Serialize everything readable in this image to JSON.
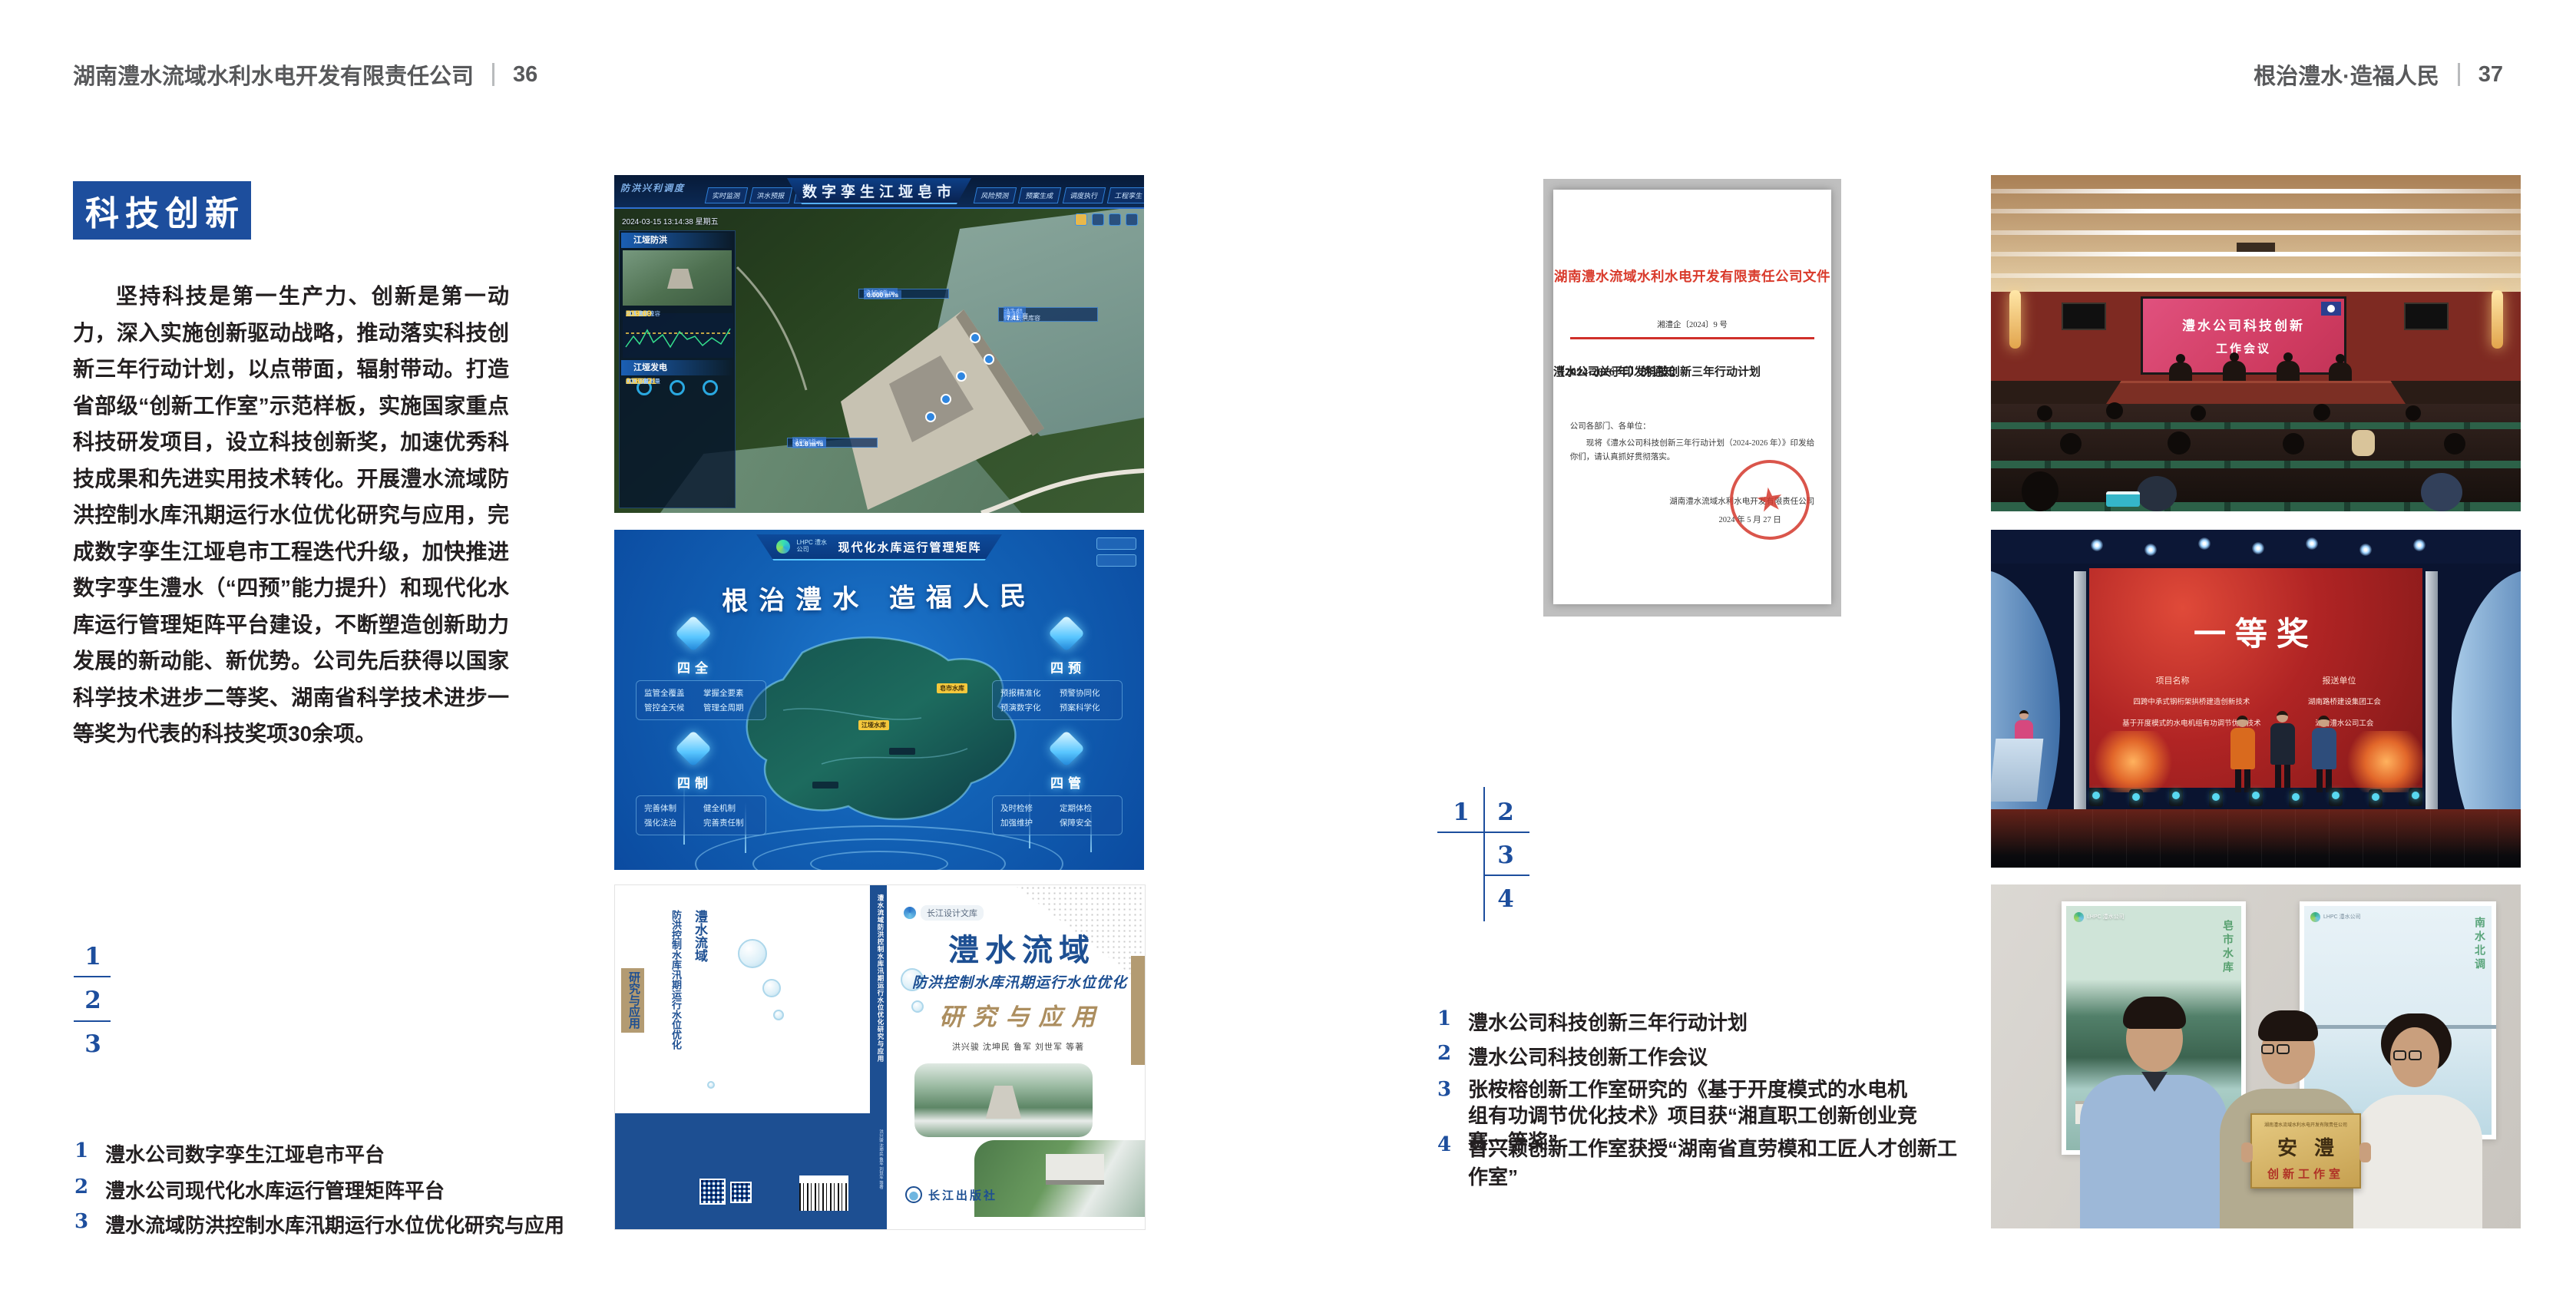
{
  "left_page": {
    "header": {
      "company": "湖南澧水流域水利水电开发有限责任公司",
      "page_no": "36"
    },
    "section_title": "科技创新",
    "paragraph": "坚持科技是第一生产力、创新是第一动力，深入实施创新驱动战略，推动落实科技创新三年行动计划，以点带面，辐射带动。打造省部级“创新工作室”示范样板，实施国家重点科技研发项目，设立科技创新奖，加速优秀科技成果和先进实用技术转化。开展澧水流域防洪控制水库汛期运行水位优化研究与应用，完成数字孪生江垭皂市工程迭代升级，加快推进数字孪生澧水（“四预”能力提升）和现代化水库运行管理矩阵平台建设，不断塑造创新助力发展的新动能、新优势。公司先后获得以国家科学技术进步二等奖、湖南省科学技术进步一等奖为代表的科技奖项30余项。",
    "figure_index": [
      "1",
      "2",
      "3"
    ],
    "captions": [
      {
        "num": "1",
        "text": "澧水公司数字孪生江垭皂市平台"
      },
      {
        "num": "2",
        "text": "澧水公司现代化水库运行管理矩阵平台"
      },
      {
        "num": "3",
        "text": "澧水流域防洪控制水库汛期运行水位优化研究与应用"
      }
    ]
  },
  "right_page": {
    "header": {
      "slogan": "根治澧水·造福人民",
      "page_no": "37"
    },
    "figure_index": [
      "1",
      "2",
      "3",
      "4"
    ],
    "captions": [
      {
        "num": "1",
        "text": "澧水公司科技创新三年行动计划"
      },
      {
        "num": "2",
        "text": "澧水公司科技创新工作会议"
      },
      {
        "num": "3",
        "text": "张桉榕创新工作室研究的《基于开度模式的水电机组有功调节优化技术》项目获“湘直职工创新创业竞赛一等奖”"
      },
      {
        "num": "4",
        "text": "曾兴颖创新工作室获授“湖南省直劳模和工匠人才创新工作室”"
      }
    ]
  },
  "document": {
    "red_head": "湖南澧水流域水利水电开发有限责任公司文件",
    "doc_no": "湘澧企〔2024〕9 号",
    "title_line1": "澧水公司关于印发科技创新三年行动计划",
    "title_line2": "（2024-2026 年）的通知",
    "salutation": "公司各部门、各单位：",
    "body": "现将《澧水公司科技创新三年行动计划（2024-2026 年）》印发给你们，请认真抓好贯彻落实。",
    "signer": "湖南澧水流域水利水电开发有限责任公司",
    "date": "2024 年 5 月 27 日",
    "seal_star": "★"
  },
  "dashboard": {
    "title": "数字孪生江垭皂市",
    "corner_label": "防洪兴利调度",
    "datetime": "2024-03-15 13:14:38 星期五",
    "tabs_left": [
      "实时监测",
      "洪水预报",
      "防洪预警"
    ],
    "tabs_right": [
      "风险预测",
      "预案生成",
      "调度执行",
      "工程孪生"
    ],
    "panel_flood": {
      "title": "江垭防洪",
      "stats": [
        {
          "label": "总库容",
          "value": "17.41"
        },
        {
          "label": "剩余防洪库容",
          "value": "7.41"
        },
        {
          "label": "坝上水位",
          "value": "215.69"
        },
        {
          "label": "蓄水量",
          "value": "8.10"
        },
        {
          "label": "入库流量",
          "value": "0.000"
        },
        {
          "label": "出库流量",
          "value": "61.8"
        },
        {
          "label": "正常蓄水位",
          "value": "236.00"
        },
        {
          "label": "汛限水位",
          "value": "219.60"
        }
      ]
    },
    "panel_power": {
      "title": "江垭发电",
      "stats": [
        {
          "label": "年发电台数",
          "value": "6.3000"
        },
        {
          "label": "年累计发电量",
          "value": "1.2907"
        },
        {
          "label": "月累计发电量",
          "value": "3359.21"
        },
        {
          "label": "当前出力",
          "value": "0.00"
        },
        {
          "label": "发电流量",
          "value": "0.00"
        },
        {
          "label": "弃水流量",
          "value": "0.00"
        }
      ]
    },
    "callout_up": [
      {
        "label": "坝上水位",
        "value": "215.69 m"
      },
      {
        "label": "入库流量",
        "value": "0.000 m³/s"
      }
    ],
    "callout_cap": [
      {
        "label": "总库容",
        "value": "17.41"
      },
      {
        "label": "蓄水量",
        "value": "8.10"
      },
      {
        "label": "防洪库容",
        "value": "7.41"
      },
      {
        "label": "剩余防洪库容",
        "value": "7.41"
      }
    ],
    "callout_down": [
      {
        "label": "坝下水位",
        "value": "106.19 m"
      },
      {
        "label": "出库流量",
        "value": "61.8 m³/s"
      }
    ]
  },
  "matrix": {
    "brand": "LHPC 澧水公司",
    "title": "现代化水库运行管理矩阵",
    "slogan": "根治澧水 造福人民",
    "marker1": "皂市水库",
    "marker2": "江垭水库",
    "groups": [
      {
        "name": "四全",
        "items": [
          "监管全覆盖",
          "掌握全要素",
          "管控全天候",
          "管理全周期"
        ]
      },
      {
        "name": "四预",
        "items": [
          "预报精准化",
          "预警协同化",
          "预演数字化",
          "预案科学化"
        ]
      },
      {
        "name": "四制",
        "items": [
          "完善体制",
          "健全机制",
          "强化法治",
          "完善责任制"
        ]
      },
      {
        "name": "四管",
        "items": [
          "及时检修",
          "定期体检",
          "加强维护",
          "保障安全"
        ]
      }
    ]
  },
  "book": {
    "series": "长江设计文库",
    "title_main": "澧水流域",
    "title_sub": "防洪控制水库汛期运行水位优化",
    "title_tail": "研究与应用",
    "authors": "洪兴骏 沈坤民 鲁军 刘世军 等著",
    "publisher": "长江出版社",
    "spine": "澧水流域防洪控制水库汛期运行水位优化研究与应用",
    "back_title_1": "澧水流域",
    "back_title_2": "防洪控制水库汛期运行水位优化",
    "back_title_3": "研究与应用"
  },
  "meeting": {
    "screen_line1": "澧水公司科技创新",
    "screen_line2": "工作会议"
  },
  "award": {
    "prize": "一等奖",
    "col1": "项目名称",
    "col2": "报送单位",
    "rows": [
      {
        "project": "四跨中承式钢桁架拱桥建造创新技术",
        "org": "湖南路桥建设集团工会"
      },
      {
        "project": "基于开度模式的水电机组有功调节优化技术",
        "org": "湖南澧水公司工会"
      }
    ]
  },
  "group_photo": {
    "plaque_company": "湖南澧水流域水利水电开发有限责任公司",
    "plaque_name": "安澧",
    "plaque_type": "创新工作室",
    "poster_left_text": "皂市水库",
    "poster_right_text": "南水北调",
    "poster_brand": "LHPC 澧水公司"
  }
}
